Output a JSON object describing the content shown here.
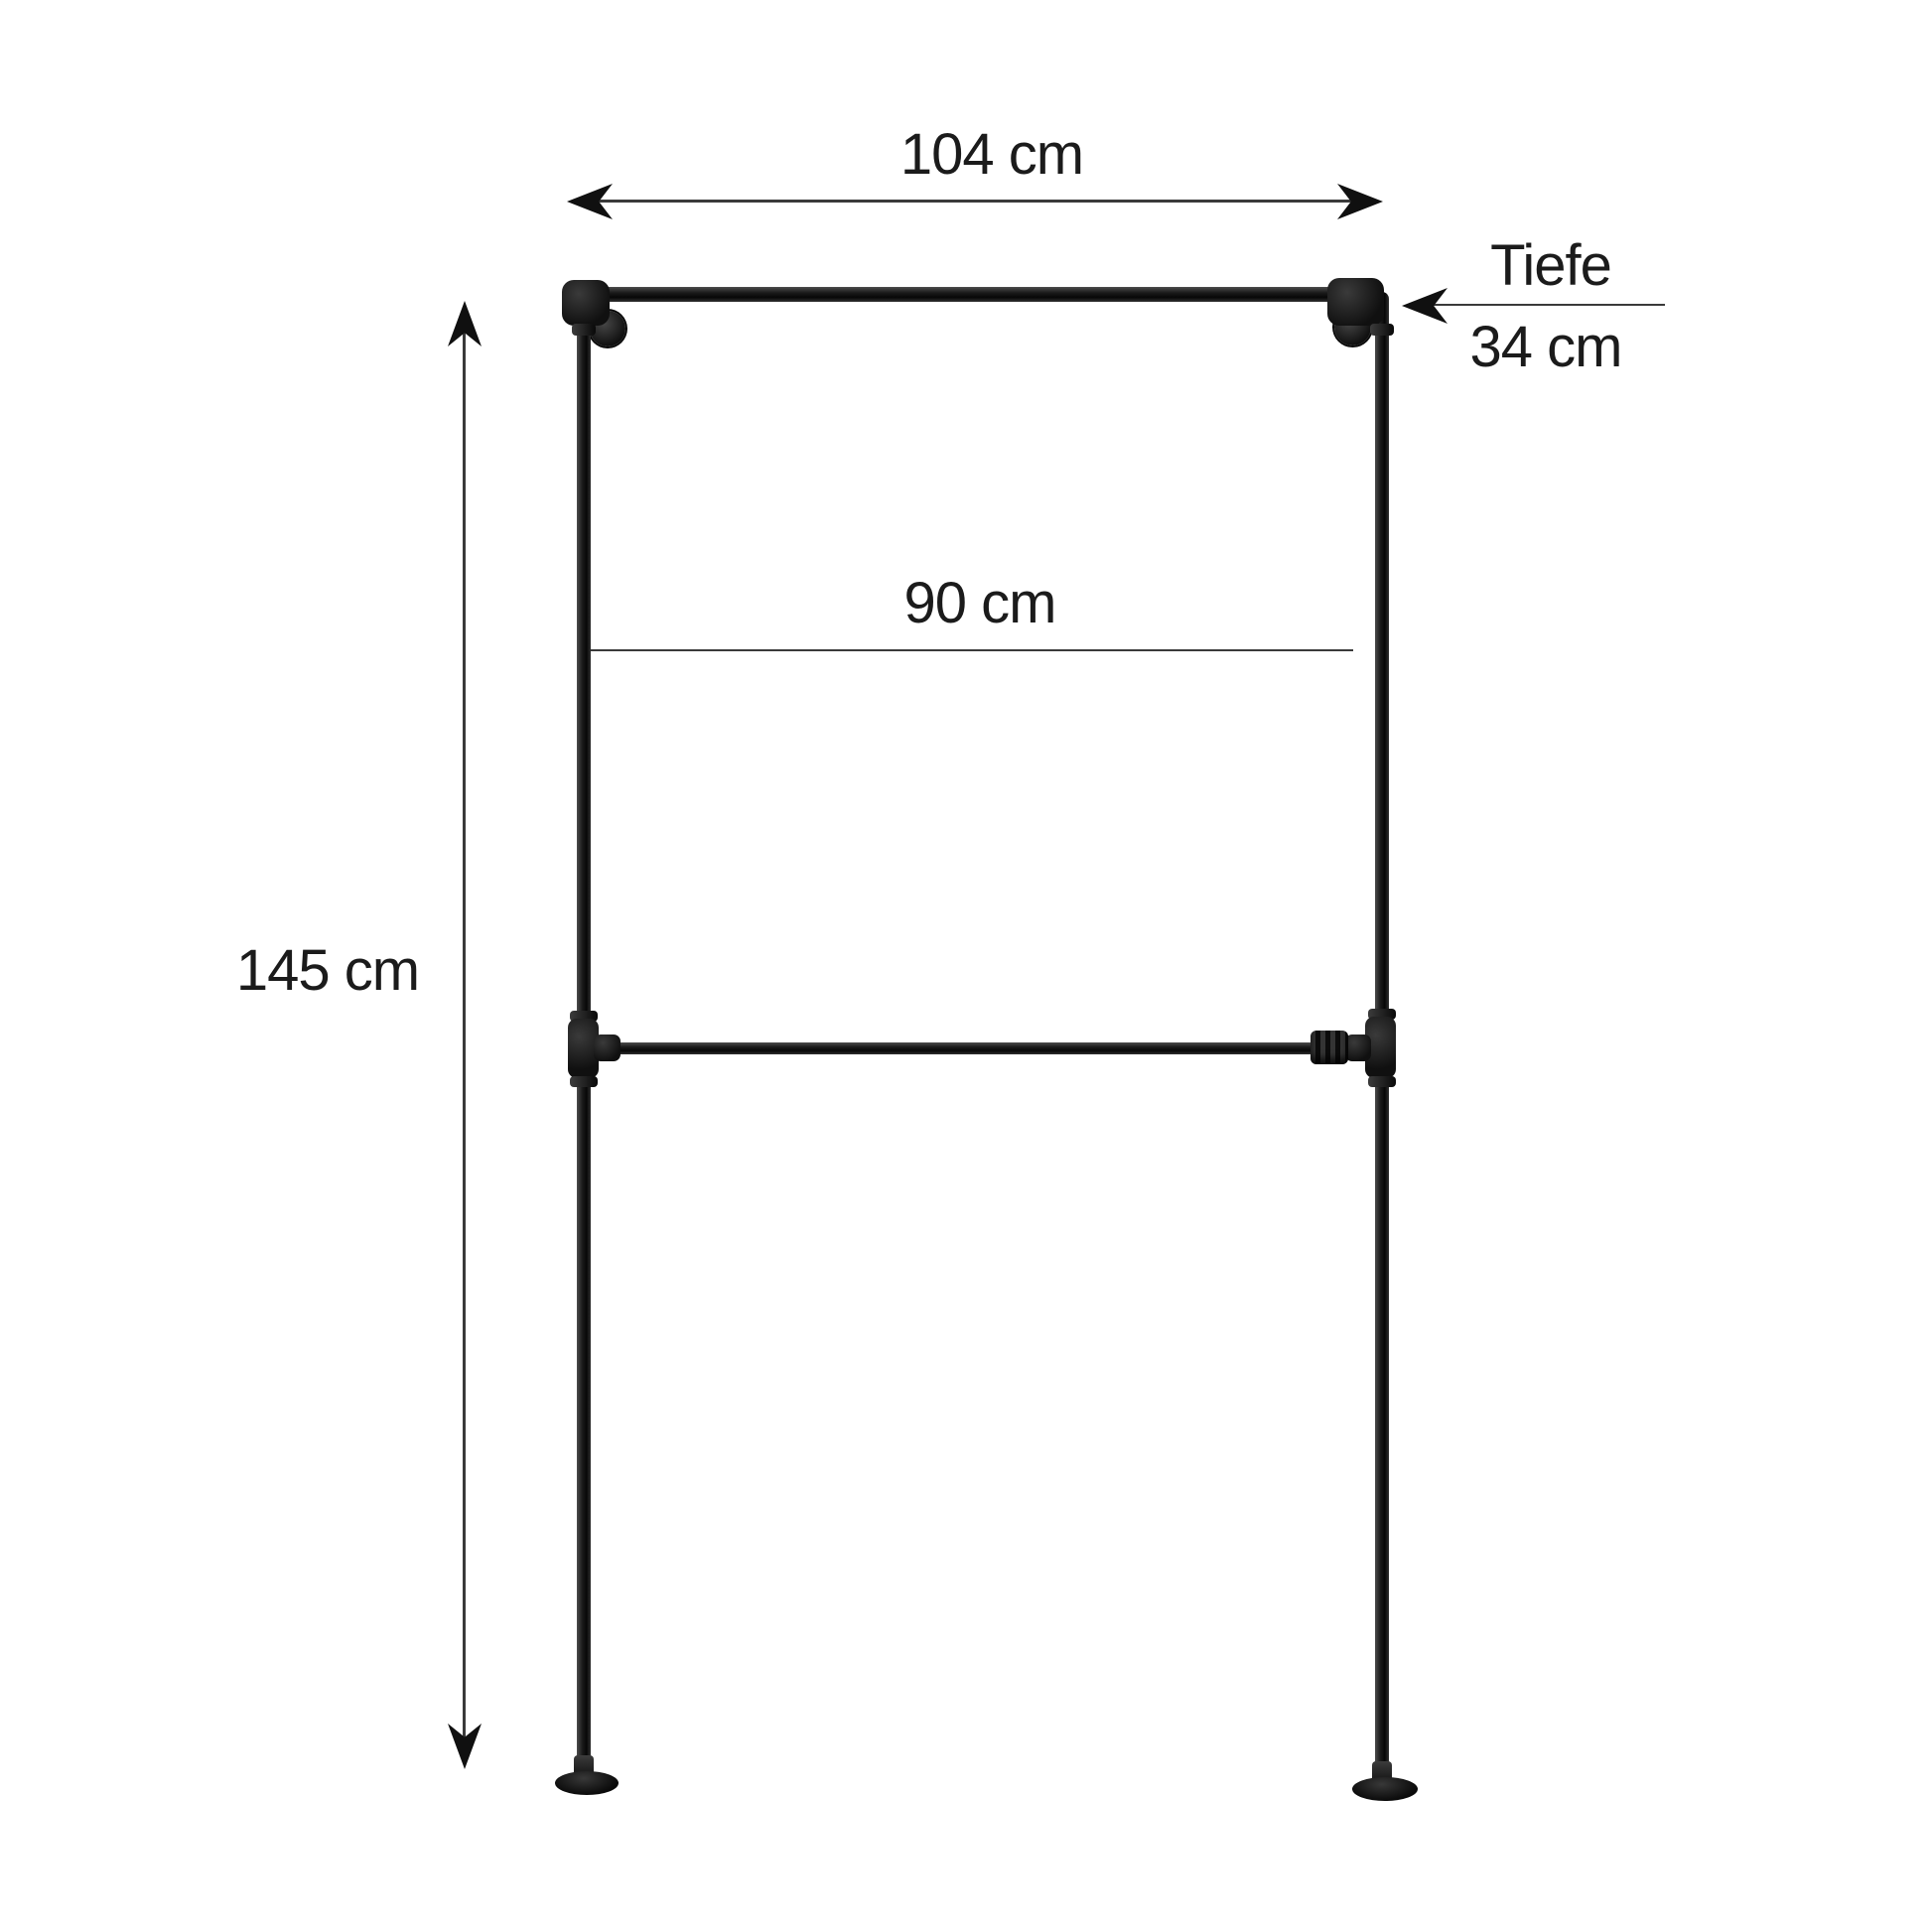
{
  "diagram": {
    "type": "product-dimension-diagram",
    "subject": "wall-mounted industrial pipe clothes rack with two hanging rails",
    "dimensions": {
      "width": "104 cm",
      "inner_width": "90 cm",
      "height": "145 cm",
      "depth_label": "Tiefe",
      "depth_value": "34 cm"
    }
  },
  "colors": {
    "background": "#ffffff",
    "text": "#1b1b1b",
    "dimension_line": "#3a3a3a",
    "arrowhead": "#101010",
    "pipe_highlight": "#4d4d4d",
    "pipe_mid": "#1c1c1c",
    "pipe_dark": "#070707",
    "pipe_edge": "#303030"
  }
}
